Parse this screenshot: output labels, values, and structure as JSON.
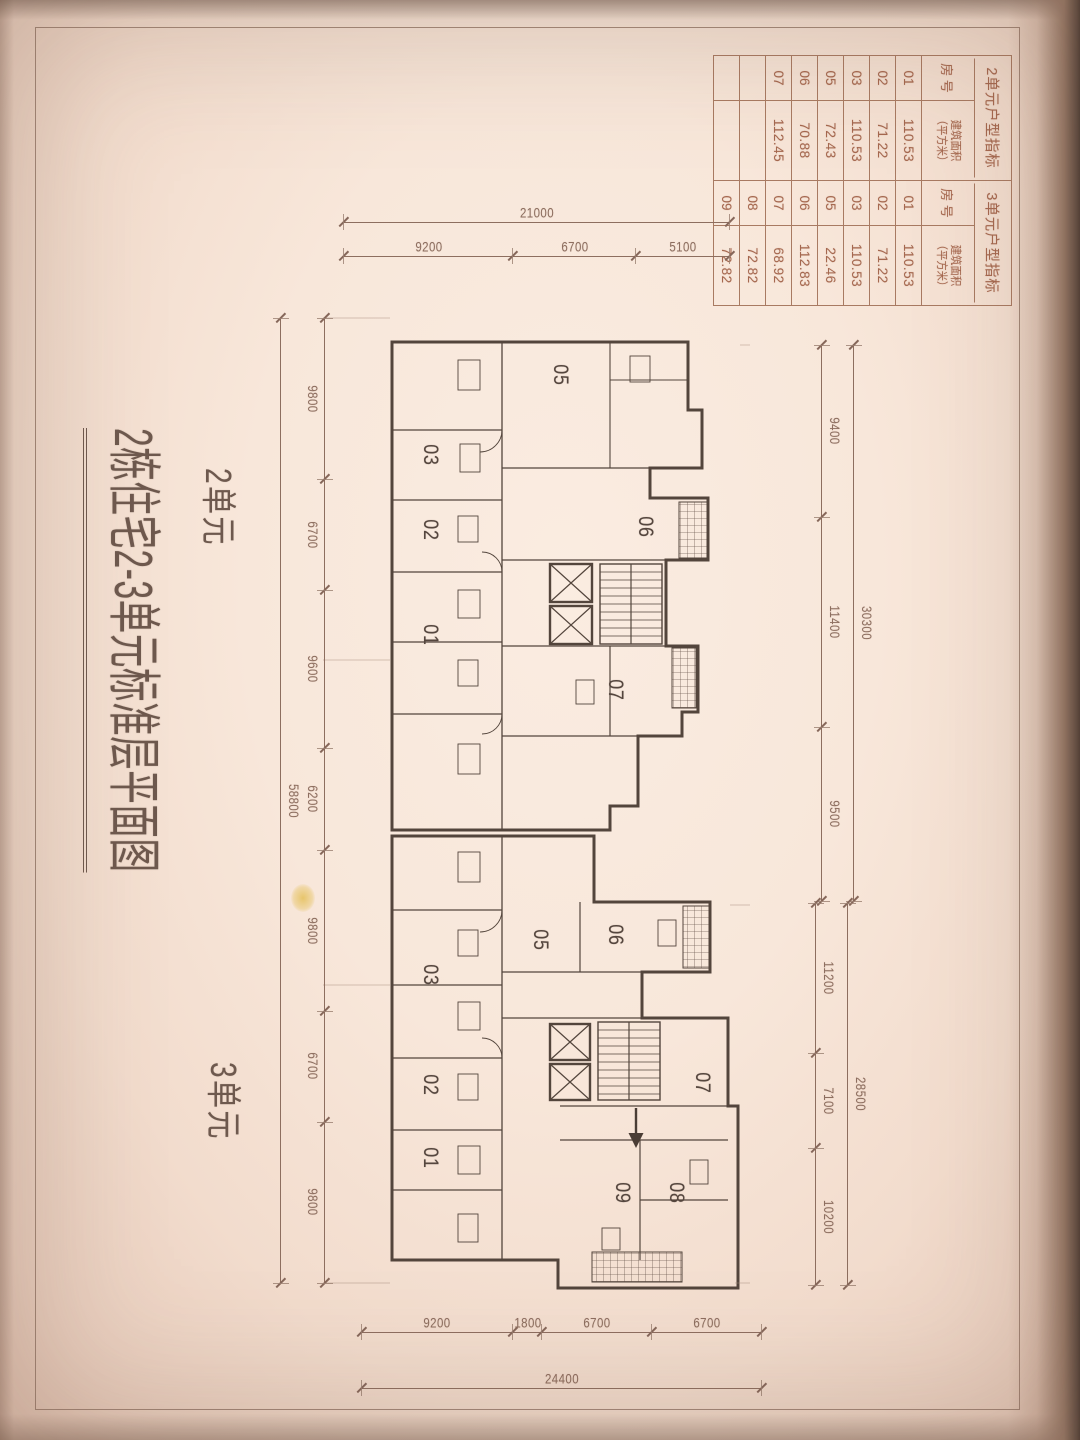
{
  "title": "2栋住宅2-3单元标准层平面图",
  "unit2_label": "2单元",
  "unit3_label": "3单元",
  "table": {
    "unit2_title": "2单元户型指标",
    "unit3_title": "3单元户型指标",
    "room_col": "房 号",
    "area_col_line1": "建筑面积",
    "area_col_line2": "（平方米）",
    "unit2_rows": [
      [
        "01",
        "110.53"
      ],
      [
        "02",
        "71.22"
      ],
      [
        "03",
        "110.53"
      ],
      [
        "05",
        "72.43"
      ],
      [
        "06",
        "70.88"
      ],
      [
        "07",
        "112.45"
      ],
      [
        "",
        ""
      ],
      [
        "",
        ""
      ]
    ],
    "unit3_rows": [
      [
        "01",
        "110.53"
      ],
      [
        "02",
        "71.22"
      ],
      [
        "03",
        "110.53"
      ],
      [
        "05",
        "22.46"
      ],
      [
        "06",
        "112.83"
      ],
      [
        "07",
        "68.92"
      ],
      [
        "08",
        "72.82"
      ],
      [
        "09",
        "72.82"
      ]
    ]
  },
  "dimensions": {
    "chains": [
      {
        "name": "top-left-grid",
        "dir": "h",
        "x": 345,
        "y": 258,
        "len": 556,
        "label_side": "before",
        "segs": [
          "9400",
          "11400",
          "9500"
        ]
      },
      {
        "name": "top-left-total",
        "dir": "h",
        "x": 345,
        "y": 226,
        "len": 556,
        "label_side": "before",
        "segs": [
          "30300"
        ]
      },
      {
        "name": "top-right-grid",
        "dir": "h",
        "x": 903,
        "y": 264,
        "len": 382,
        "label_side": "before",
        "segs": [
          "11200",
          "7100",
          "10200"
        ]
      },
      {
        "name": "top-right-total",
        "dir": "h",
        "x": 903,
        "y": 232,
        "len": 382,
        "label_side": "before",
        "segs": [
          "28500"
        ]
      },
      {
        "name": "bottom-grid",
        "dir": "h",
        "x": 318,
        "y": 755,
        "len": 965,
        "label_side": "after",
        "segs": [
          "9800",
          "6700",
          "9600",
          "6200",
          "9800",
          "6700",
          "9800"
        ]
      },
      {
        "name": "bottom-total",
        "dir": "h",
        "x": 318,
        "y": 799,
        "len": 965,
        "label_side": "before",
        "segs": [
          "58800"
        ]
      },
      {
        "name": "left-grid",
        "dir": "v",
        "x": 256,
        "y": 350,
        "len": 386,
        "label_side": "before",
        "segs": [
          "5100",
          "6700",
          "9200"
        ]
      },
      {
        "name": "left-total",
        "dir": "v",
        "x": 222,
        "y": 350,
        "len": 386,
        "label_side": "before",
        "segs": [
          "21000"
        ]
      },
      {
        "name": "right-grid",
        "dir": "v",
        "x": 1332,
        "y": 318,
        "len": 400,
        "label_side": "before",
        "segs": [
          "6700",
          "6700",
          "1800",
          "9200"
        ]
      },
      {
        "name": "right-total",
        "dir": "v",
        "x": 1388,
        "y": 318,
        "len": 400,
        "label_side": "before",
        "segs": [
          "24400"
        ]
      }
    ]
  },
  "rooms": [
    {
      "unit": "2单元",
      "label": "05",
      "x": 375,
      "y": 520
    },
    {
      "unit": "2单元",
      "label": "06",
      "x": 527,
      "y": 435
    },
    {
      "unit": "2单元",
      "label": "07",
      "x": 690,
      "y": 465
    },
    {
      "unit": "2单元",
      "label": "03",
      "x": 455,
      "y": 650
    },
    {
      "unit": "2单元",
      "label": "02",
      "x": 530,
      "y": 650
    },
    {
      "unit": "2单元",
      "label": "01",
      "x": 635,
      "y": 650
    },
    {
      "unit": "3单元",
      "label": "06",
      "x": 935,
      "y": 465
    },
    {
      "unit": "3单元",
      "label": "05",
      "x": 940,
      "y": 540
    },
    {
      "unit": "3单元",
      "label": "07",
      "x": 1083,
      "y": 378
    },
    {
      "unit": "3单元",
      "label": "08",
      "x": 1193,
      "y": 404
    },
    {
      "unit": "3单元",
      "label": "09",
      "x": 1193,
      "y": 458
    },
    {
      "unit": "3单元",
      "label": "03",
      "x": 975,
      "y": 650
    },
    {
      "unit": "3单元",
      "label": "02",
      "x": 1085,
      "y": 650
    },
    {
      "unit": "3单元",
      "label": "01",
      "x": 1158,
      "y": 650
    }
  ],
  "colors": {
    "paper": "#f8e7da",
    "ink_plan": "#53453c",
    "ink_dim": "#8d6e5f",
    "ink_table": "#a5684f",
    "ink_title": "#6e594e"
  }
}
